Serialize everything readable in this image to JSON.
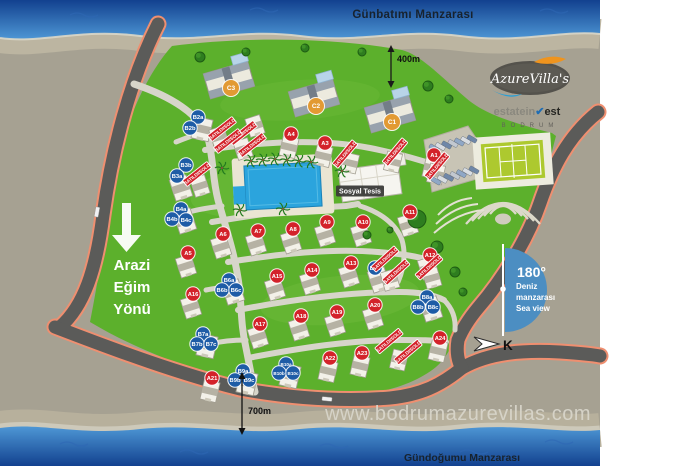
{
  "header": {
    "top_caption": "Günbatımı Manzarası",
    "bottom_caption": "Gündoğumu Manzarası",
    "website": "www.bodrumazurevillas.com"
  },
  "brand": {
    "name": "AzureVilla's",
    "estate": {
      "left": "estatein",
      "check": "✔",
      "right": "est",
      "sub": "BODRUM"
    }
  },
  "annotations": {
    "distance_top": "400m",
    "distance_bottom": "700m",
    "slope": {
      "line1": "Arazi",
      "line2": "Eğim",
      "line3": "Yönü"
    },
    "sea_view": {
      "degrees": "180°",
      "line1": "Deniz",
      "line2": "manzarası",
      "line3": "Sea view"
    },
    "compass": "K",
    "social_facility": "Sosyal Tesis",
    "sold_label": "SATILDI/SOLD"
  },
  "colors": {
    "villa_a": "#d3222a",
    "villa_b": "#1e5ca6",
    "villa_c": "#e29a33",
    "sold_banner": "#d3222a",
    "sea_deep": "#12418f",
    "sea_light": "#4e97d5",
    "lawn_green": "#5cb02c",
    "road_edge": "#ef8f70",
    "road_dark": "#5b5b59",
    "sea_view_badge": "#4c8ec2"
  },
  "villas": [
    {
      "id": "C3",
      "type": "C",
      "x": 231,
      "y": 88
    },
    {
      "id": "C2",
      "type": "C",
      "x": 316,
      "y": 106
    },
    {
      "id": "C1",
      "type": "C",
      "x": 392,
      "y": 122
    },
    {
      "id": "A1",
      "type": "A",
      "x": 434,
      "y": 155
    },
    {
      "id": "A3",
      "type": "A",
      "x": 325,
      "y": 143
    },
    {
      "id": "A4",
      "type": "A",
      "x": 291,
      "y": 134
    },
    {
      "id": "A5",
      "type": "A",
      "x": 188,
      "y": 253
    },
    {
      "id": "A6",
      "type": "A",
      "x": 223,
      "y": 234
    },
    {
      "id": "A7",
      "type": "A",
      "x": 258,
      "y": 231
    },
    {
      "id": "A8",
      "type": "A",
      "x": 293,
      "y": 229
    },
    {
      "id": "A9",
      "type": "A",
      "x": 327,
      "y": 222
    },
    {
      "id": "A10",
      "type": "A",
      "x": 363,
      "y": 222
    },
    {
      "id": "A11",
      "type": "A",
      "x": 410,
      "y": 212
    },
    {
      "id": "A12",
      "type": "A",
      "x": 430,
      "y": 255
    },
    {
      "id": "A13",
      "type": "A",
      "x": 351,
      "y": 263
    },
    {
      "id": "A14",
      "type": "A",
      "x": 312,
      "y": 270
    },
    {
      "id": "A15",
      "type": "A",
      "x": 277,
      "y": 276
    },
    {
      "id": "A16",
      "type": "A",
      "x": 193,
      "y": 294
    },
    {
      "id": "A17",
      "type": "A",
      "x": 260,
      "y": 324
    },
    {
      "id": "A18",
      "type": "A",
      "x": 301,
      "y": 316
    },
    {
      "id": "A19",
      "type": "A",
      "x": 337,
      "y": 312
    },
    {
      "id": "A20",
      "type": "A",
      "x": 375,
      "y": 305
    },
    {
      "id": "A21",
      "type": "A",
      "x": 212,
      "y": 378
    },
    {
      "id": "A22",
      "type": "A",
      "x": 330,
      "y": 358
    },
    {
      "id": "A23",
      "type": "A",
      "x": 362,
      "y": 353
    },
    {
      "id": "A24",
      "type": "A",
      "x": 440,
      "y": 338
    },
    {
      "id": "B2a",
      "type": "B",
      "x": 198,
      "y": 117
    },
    {
      "id": "B2b",
      "type": "B",
      "x": 190,
      "y": 128
    },
    {
      "id": "B3b",
      "type": "B",
      "x": 186,
      "y": 165
    },
    {
      "id": "B3a",
      "type": "B",
      "x": 177,
      "y": 176
    },
    {
      "id": "B4a",
      "type": "B",
      "x": 181,
      "y": 209
    },
    {
      "id": "B4b",
      "type": "B",
      "x": 172,
      "y": 219
    },
    {
      "id": "B4c",
      "type": "B",
      "x": 186,
      "y": 220
    },
    {
      "id": "B5a",
      "type": "B",
      "x": 375,
      "y": 268
    },
    {
      "id": "B6a",
      "type": "B",
      "x": 229,
      "y": 280
    },
    {
      "id": "B6b",
      "type": "B",
      "x": 222,
      "y": 290
    },
    {
      "id": "B6c",
      "type": "B",
      "x": 236,
      "y": 290
    },
    {
      "id": "B7a",
      "type": "B",
      "x": 203,
      "y": 334
    },
    {
      "id": "B7b",
      "type": "B",
      "x": 197,
      "y": 344
    },
    {
      "id": "B7c",
      "type": "B",
      "x": 211,
      "y": 344
    },
    {
      "id": "B8a",
      "type": "B",
      "x": 427,
      "y": 297
    },
    {
      "id": "B8b",
      "type": "B",
      "x": 418,
      "y": 307
    },
    {
      "id": "B8c",
      "type": "B",
      "x": 433,
      "y": 307
    },
    {
      "id": "B9a",
      "type": "B",
      "x": 243,
      "y": 371
    },
    {
      "id": "B9b",
      "type": "B",
      "x": 235,
      "y": 380
    },
    {
      "id": "B9c",
      "type": "B",
      "x": 249,
      "y": 380
    },
    {
      "id": "B10a",
      "type": "B",
      "x": 286,
      "y": 364
    },
    {
      "id": "B10b",
      "type": "B",
      "x": 279,
      "y": 373
    },
    {
      "id": "B10c",
      "type": "B",
      "x": 293,
      "y": 373
    }
  ],
  "sold_banners": [
    {
      "x": 222,
      "y": 129,
      "rot": -38
    },
    {
      "x": 243,
      "y": 133,
      "rot": -38
    },
    {
      "x": 228,
      "y": 141,
      "rot": -38
    },
    {
      "x": 252,
      "y": 145,
      "rot": -38
    },
    {
      "x": 197,
      "y": 174,
      "rot": -38
    },
    {
      "x": 345,
      "y": 154,
      "rot": -50
    },
    {
      "x": 395,
      "y": 152,
      "rot": -50
    },
    {
      "x": 437,
      "y": 166,
      "rot": -50
    },
    {
      "x": 385,
      "y": 259,
      "rot": -42
    },
    {
      "x": 396,
      "y": 272,
      "rot": -42
    },
    {
      "x": 429,
      "y": 267,
      "rot": -42
    },
    {
      "x": 389,
      "y": 341,
      "rot": -40
    },
    {
      "x": 408,
      "y": 352,
      "rot": -40
    }
  ]
}
